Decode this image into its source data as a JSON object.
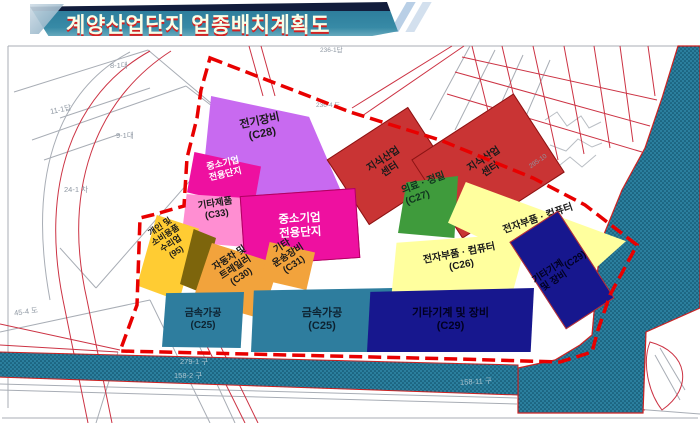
{
  "title": {
    "text": "계양산업단지 업종배치계획도"
  },
  "zones": [
    {
      "name": "electrical-equipment",
      "label": "전기장비",
      "code": "(C28)",
      "color": "#c86af0",
      "text_color": "#1a1a1a"
    },
    {
      "name": "knowledge-industry-center-west",
      "label": "지식산업\n센터",
      "code": "",
      "color": "#c93434",
      "text_color": "#1a1a1a"
    },
    {
      "name": "knowledge-industry-center-east",
      "label": "지식산업\n센터",
      "code": "",
      "color": "#c93434",
      "text_color": "#1a1a1a"
    },
    {
      "name": "sme-dedicated-complex-small",
      "label": "중소기업\n전용단지",
      "code": "",
      "color": "#ee10a0",
      "text_color": "#ffffff"
    },
    {
      "name": "other-products",
      "label": "기타제품",
      "code": "(C33)",
      "color": "#ff8ed2",
      "text_color": "#1a1a1a"
    },
    {
      "name": "sme-dedicated-complex-large",
      "label": "중소기업\n전용단지",
      "code": "",
      "color": "#ee10a0",
      "text_color": "#ffffff"
    },
    {
      "name": "personal-consumer-goods-repair",
      "label": "개인 및\n소비용품\n수리업",
      "code": "(95)",
      "color": "#ffcc33",
      "text_color": "#1a1a1a"
    },
    {
      "name": "unlabeled-strip",
      "label": "",
      "code": "",
      "color": "#7d650c",
      "text_color": "#1a1a1a"
    },
    {
      "name": "automobile-trailer",
      "label": "자동차 및\n트레일러",
      "code": "(C30)",
      "color": "#f2a33c",
      "text_color": "#1a1a1a"
    },
    {
      "name": "other-transport-equipment",
      "label": "기타\n운송장비",
      "code": "(C31)",
      "color": "#f2a33c",
      "text_color": "#1a1a1a"
    },
    {
      "name": "metal-processing-west",
      "label": "금속가공",
      "code": "(C25)",
      "color": "#2e7d9e",
      "text_color": "#0d2230"
    },
    {
      "name": "metal-processing-east",
      "label": "금속가공",
      "code": "(C25)",
      "color": "#2e7d9e",
      "text_color": "#0d2230"
    },
    {
      "name": "medical-precision",
      "label": "의료 · 정밀",
      "code": "(C27)",
      "color": "#3f9b3c",
      "text_color": "#10331f"
    },
    {
      "name": "electronics-computer-north",
      "label": "전자부품 · 컴퓨터",
      "code": "(C26)",
      "color": "#ffff9e",
      "text_color": "#1a1a1a"
    },
    {
      "name": "electronics-computer-south",
      "label": "전자부품 · 컴퓨터",
      "code": "(C26)",
      "color": "#ffff9e",
      "text_color": "#1a1a1a"
    },
    {
      "name": "other-machinery-equipment-east",
      "label": "기타기계\n및 장비",
      "code": "(C29)",
      "color": "#17178e",
      "text_color": "#000020"
    },
    {
      "name": "other-machinery-equipment-south",
      "label": "기타기계 및 장비",
      "code": "(C29)",
      "color": "#17178e",
      "text_color": "#000020"
    }
  ],
  "parcels": [
    "8-1대",
    "11-1답",
    "9-1대",
    "24-1 차",
    "45-4 도",
    "236-1답",
    "279-1 구",
    "158-2 구",
    "158-11 구",
    "236-4 도",
    "295-10"
  ],
  "colors": {
    "water": "#2b7f9e",
    "water_dot": "#0d4a63",
    "boundary": "#e80000",
    "cadastral_red": "#cc3344",
    "cadastral_gray": "#a8adb5",
    "banner_teal": "#2e7e9c",
    "banner_navy": "#121d3c",
    "title_text": "#f7ffe9",
    "title_shadow": "#d42121"
  }
}
